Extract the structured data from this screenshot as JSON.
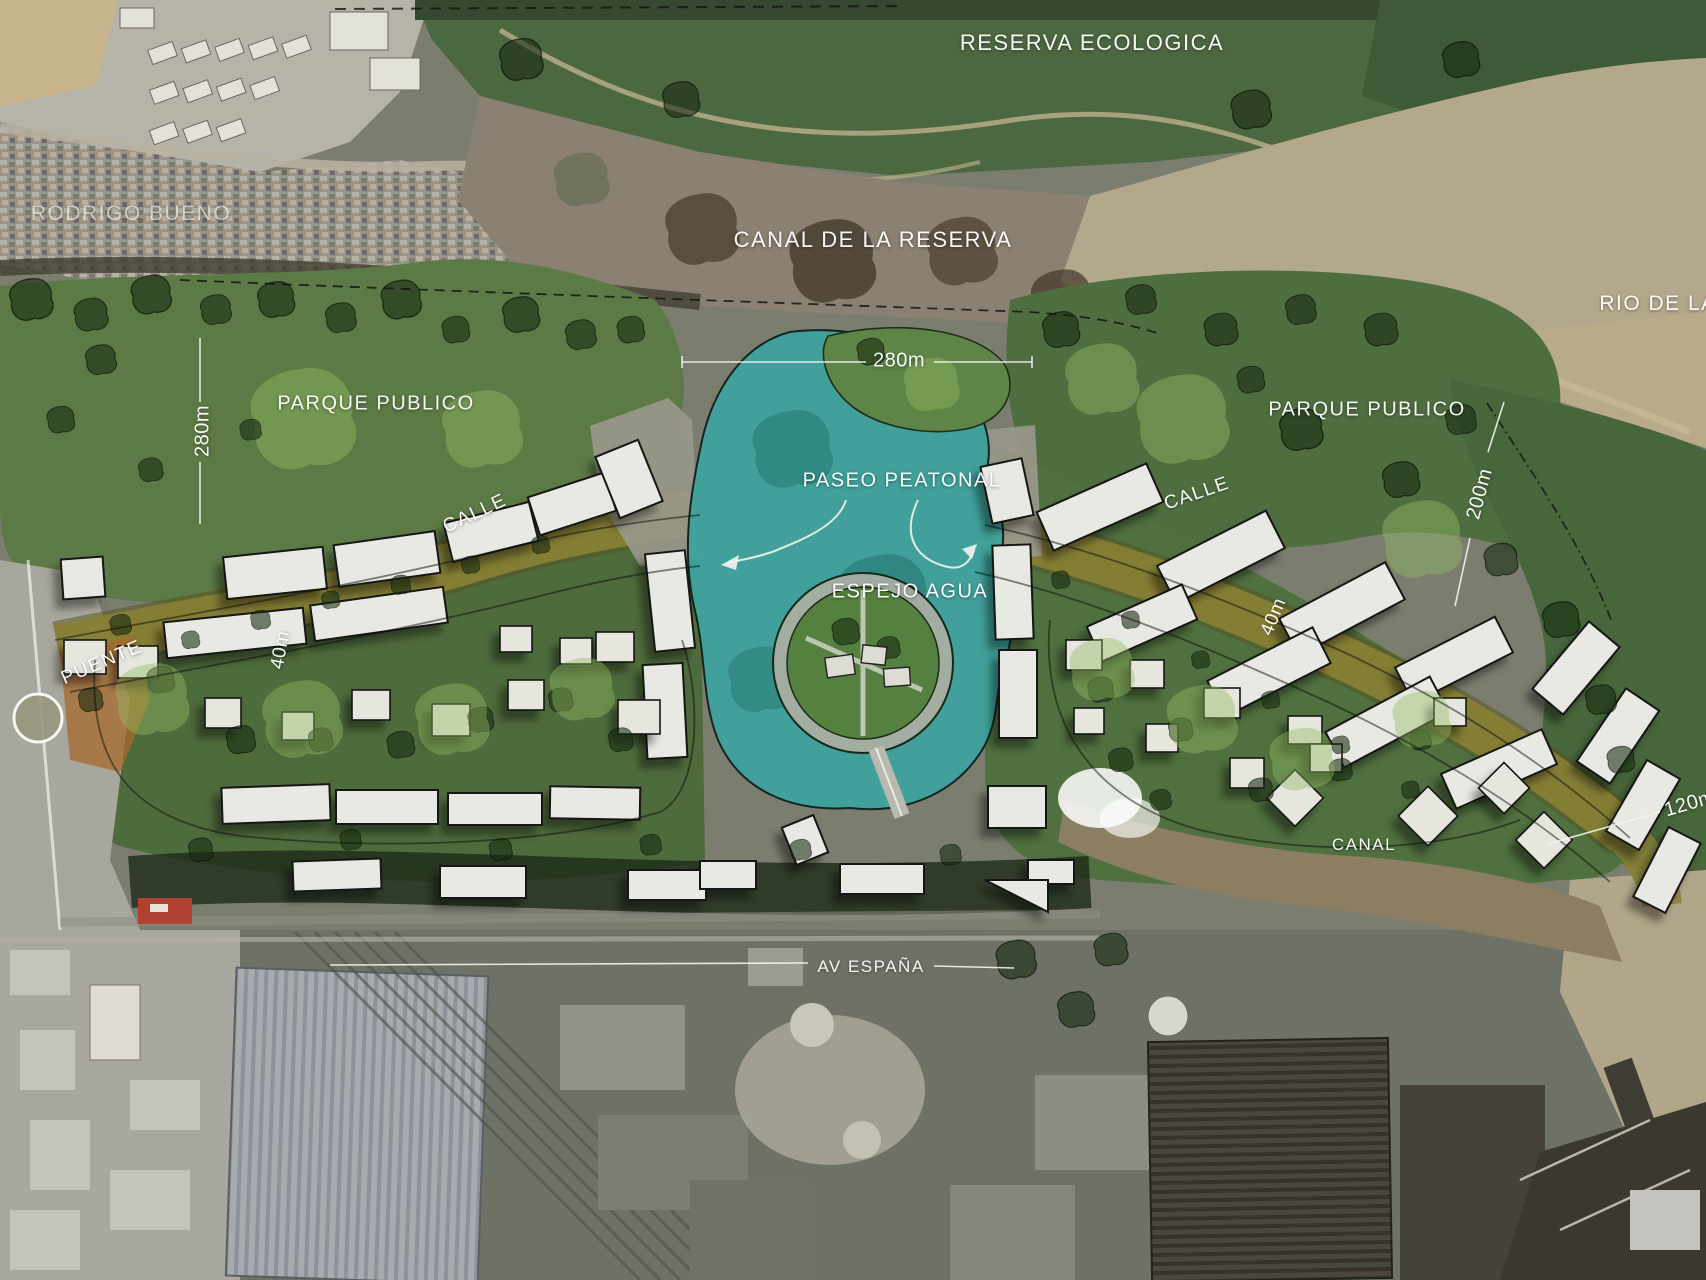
{
  "map": {
    "region_labels": {
      "reserva_ecologica": "RESERVA ECOLOGICA",
      "rodrigo_bueno": "RODRIGO BUENO",
      "canal_de_la_reserva": "CANAL DE LA RESERVA",
      "rio_de_la_plata": "RIO DE LA",
      "parque_publico_left": "PARQUE PUBLICO",
      "parque_publico_right": "PARQUE PUBLICO",
      "paseo_peatonal": "PASEO PEATONAL",
      "espejo_agua": "ESPEJO AGUA",
      "calle_left": "CALLE",
      "calle_right": "CALLE",
      "puente": "PUENTE",
      "av_espana": "AV ESPAÑA",
      "canal": "CANAL"
    },
    "dimension_labels": {
      "park_left_width": "280m",
      "lake_width": "280m",
      "park_right_depth": "200m",
      "band_left_width": "40m",
      "band_right_width": "40m",
      "edge_right_length": "120m"
    },
    "colors": {
      "lake_water": "#3FA29D",
      "river_water": "#B4A88C",
      "canal_water": "#8C7E62",
      "park_green": "#55703F",
      "street_band": "#8A8135",
      "building_fill": "#E9E9E3",
      "label_text": "#FFFFFF"
    }
  }
}
